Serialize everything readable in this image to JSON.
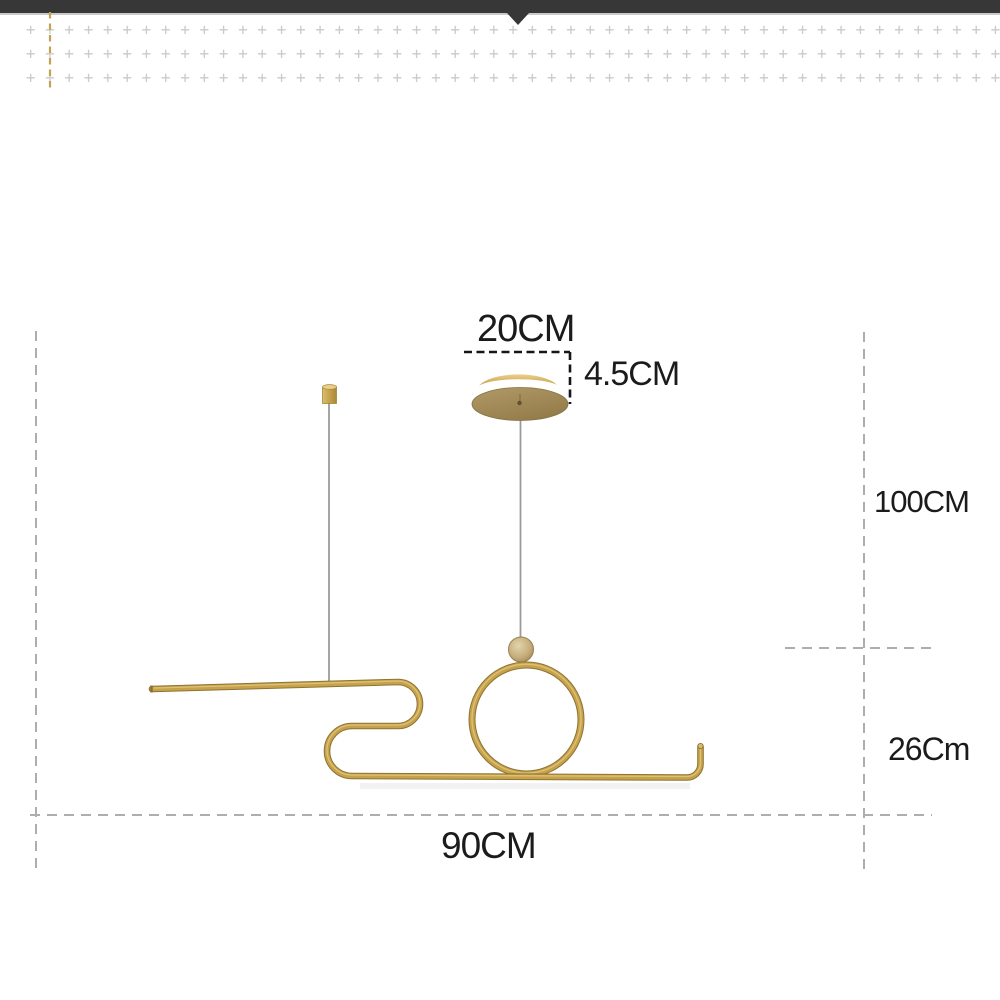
{
  "canvas": {
    "width": 1000,
    "height": 1000,
    "background": "#ffffff"
  },
  "top_bar": {
    "color": "#373737",
    "underline_color": "#c9c9c9",
    "pointer_x": 518
  },
  "decor_pattern": {
    "glyph": "+",
    "rows": 3,
    "cols": 51,
    "color": "#cbcbcb"
  },
  "colors": {
    "gold": "#C6A24C",
    "gold_dark": "#8E7330",
    "gold_light": "#E3C77E",
    "canopy_light": "#B29A68",
    "canopy_dark": "#947C4B",
    "crescent_light": "#EDD08E",
    "crescent_dark": "#C09B3E",
    "ball_light": "#E2D4AC",
    "ball_dark": "#A18852",
    "wire": "#9b9b9b",
    "dash_gray": "#aeaeae",
    "dash_black": "#161616",
    "dash_gold": "#c3a251",
    "label": "#1b1b1b"
  },
  "dimensions": {
    "canopy_width": {
      "label": "20CM",
      "value_cm": 20
    },
    "canopy_height": {
      "label": "4.5CM",
      "value_cm": 4.5
    },
    "drop_length": {
      "label": "100CM",
      "value_cm": 100
    },
    "fixture_height": {
      "label": "26Cm",
      "value_cm": 26
    },
    "fixture_width": {
      "label": "90CM",
      "value_cm": 90
    }
  }
}
